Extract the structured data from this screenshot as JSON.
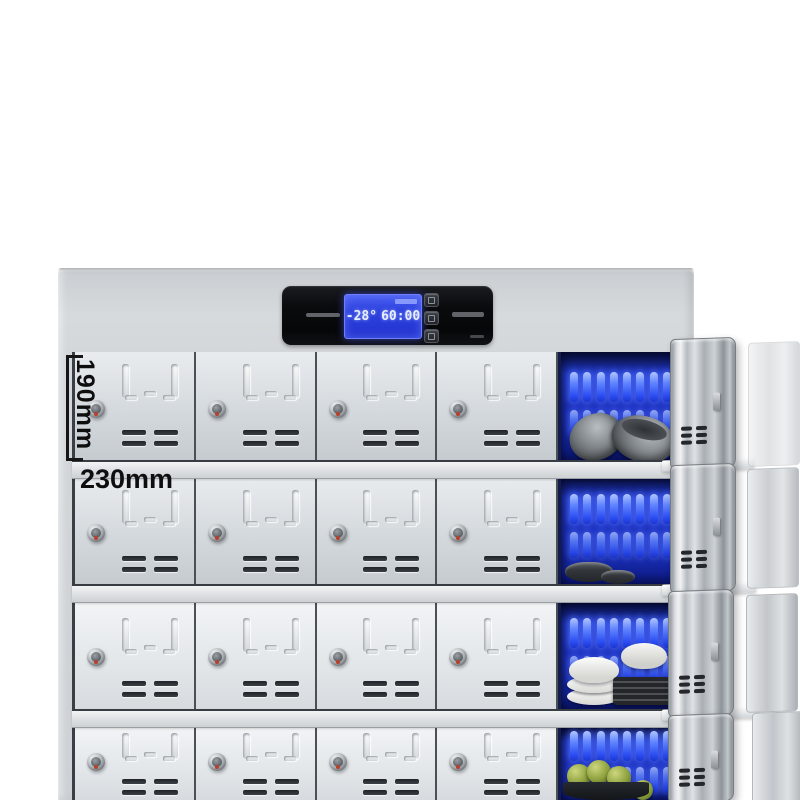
{
  "annotations": {
    "compartment_height_label": "190mm",
    "compartment_width_label": "230mm"
  },
  "control_panel": {
    "lcd": {
      "temperature": "-28°",
      "timer": "60:00"
    },
    "buttons": [
      "set-button",
      "up-button",
      "down-button"
    ]
  },
  "colors": {
    "lcd_blue": "#2c40dd",
    "uv_interior_blue": "#1c30bd",
    "cabinet_gray": "#d3d7da",
    "panel_black": "#0a0b0d",
    "lock_red_dot": "#b8402d"
  },
  "grid": {
    "rows": [
      {
        "id": "row-1",
        "doors": 4,
        "compartment_contents": "gray-bowls"
      },
      {
        "id": "row-2",
        "doors": 4,
        "compartment_contents": "small-dark-bowls"
      },
      {
        "id": "row-3",
        "doors": 4,
        "compartment_contents": "white-dishes-and-plates"
      },
      {
        "id": "row-4",
        "doors": 4,
        "compartment_contents": "green-fruit-in-bowl"
      }
    ]
  }
}
